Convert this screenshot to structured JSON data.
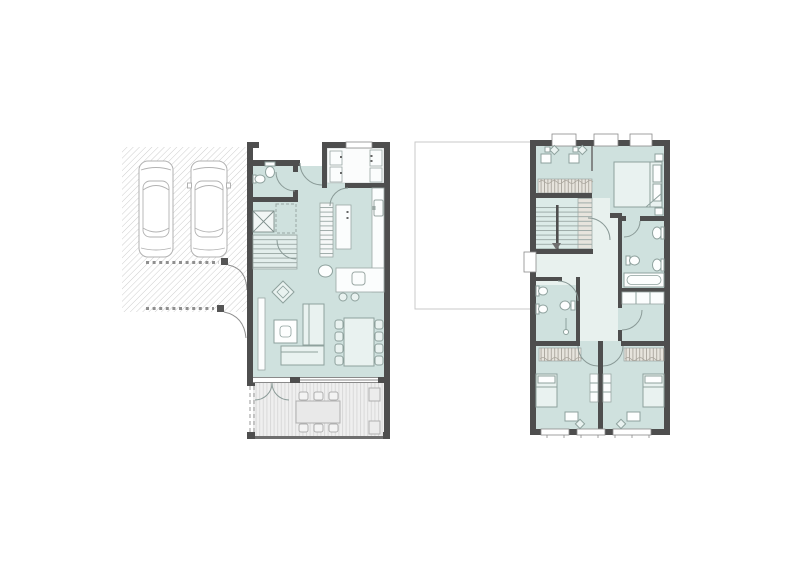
{
  "document": {
    "type": "architectural floor plan drawing",
    "visible_text": []
  },
  "palette": {
    "background": "#ffffff",
    "wall": "#4e4e4e",
    "floor_teal": "#cfe1de",
    "floor_light": "#e8f1ee",
    "room_white": "#fbfcfc",
    "furniture_line": "#8ea19d",
    "outline_gray": "#b2b2b2",
    "hatch_line": "#cdcdcd",
    "deck_base": "#efefef",
    "deck_stripe": "#d9d9d9",
    "wardrobe_fill": "#e7e4dd",
    "wardrobe_line": "#a9a59c",
    "glass_line": "#8a8a8a"
  },
  "plans": {
    "ground_floor": {
      "position": "left",
      "features": [
        "diagonally-hatched driveway",
        "two parked cars",
        "fence-dash rows with gate swing arcs",
        "entrance porch with door swing",
        "wc with toilet and sink",
        "staircase with void marker",
        "white pantry room with cabinets",
        "kitchen counter with sink and cooktop",
        "kitchen shelving island and tall cabinet",
        "island counter with basin and two stools",
        "living room with L-sofa, armchair, coffee table and sideboard",
        "dining table with eight chairs",
        "glazed south wall",
        "decked terrace with double door, outdoor table, six chairs and two planters"
      ],
      "counts": {
        "cars": 2,
        "dining_chairs": 8,
        "terrace_chairs": 6
      }
    },
    "upper_floor": {
      "position": "right",
      "features": [
        "flat garage roof outline",
        "three windows on north wall",
        "study nook with two desks and chairs",
        "wardrobe strips with hatching",
        "double-flight staircase with arrow",
        "master bedroom with double bed and nightstands",
        "en-suite bathroom with two sinks, toilet and bathtub",
        "corridor in lighter tint with west window",
        "second bathroom with two sinks, toilet and shower",
        "built-in closet",
        "two rear bedrooms with beds, dressers, desks and chairs",
        "three windows on south wall"
      ],
      "counts": {
        "bedrooms": 3,
        "bathrooms": 2,
        "desks": 4,
        "windows_north": 3,
        "windows_south": 3
      }
    }
  }
}
